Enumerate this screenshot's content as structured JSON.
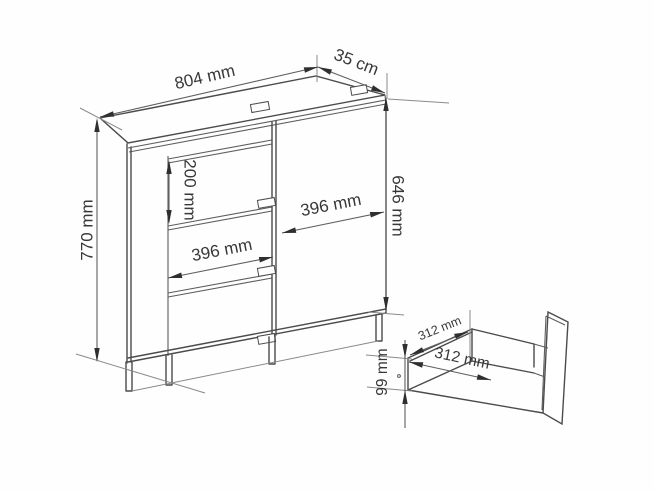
{
  "diagram": {
    "type": "furniture-dimension-diagram",
    "subject": "chest of drawers with three drawers and one door, with open drawer inset",
    "labels": {
      "overall_width": "804 mm",
      "overall_depth": "35 cm",
      "overall_height": "770 mm",
      "top_drawer_height": "200 mm",
      "drawer_front_width": "396 mm",
      "door_width": "396 mm",
      "door_height": "646 mm",
      "drawer_inner_depth": "312 mm",
      "drawer_inner_width": "312 mm",
      "drawer_inner_height": "99 mm"
    },
    "colors": {
      "background": "#ffffff",
      "line": "#4b4b4b",
      "dimension_line": "#5f5f5f",
      "text": "#383838"
    }
  }
}
